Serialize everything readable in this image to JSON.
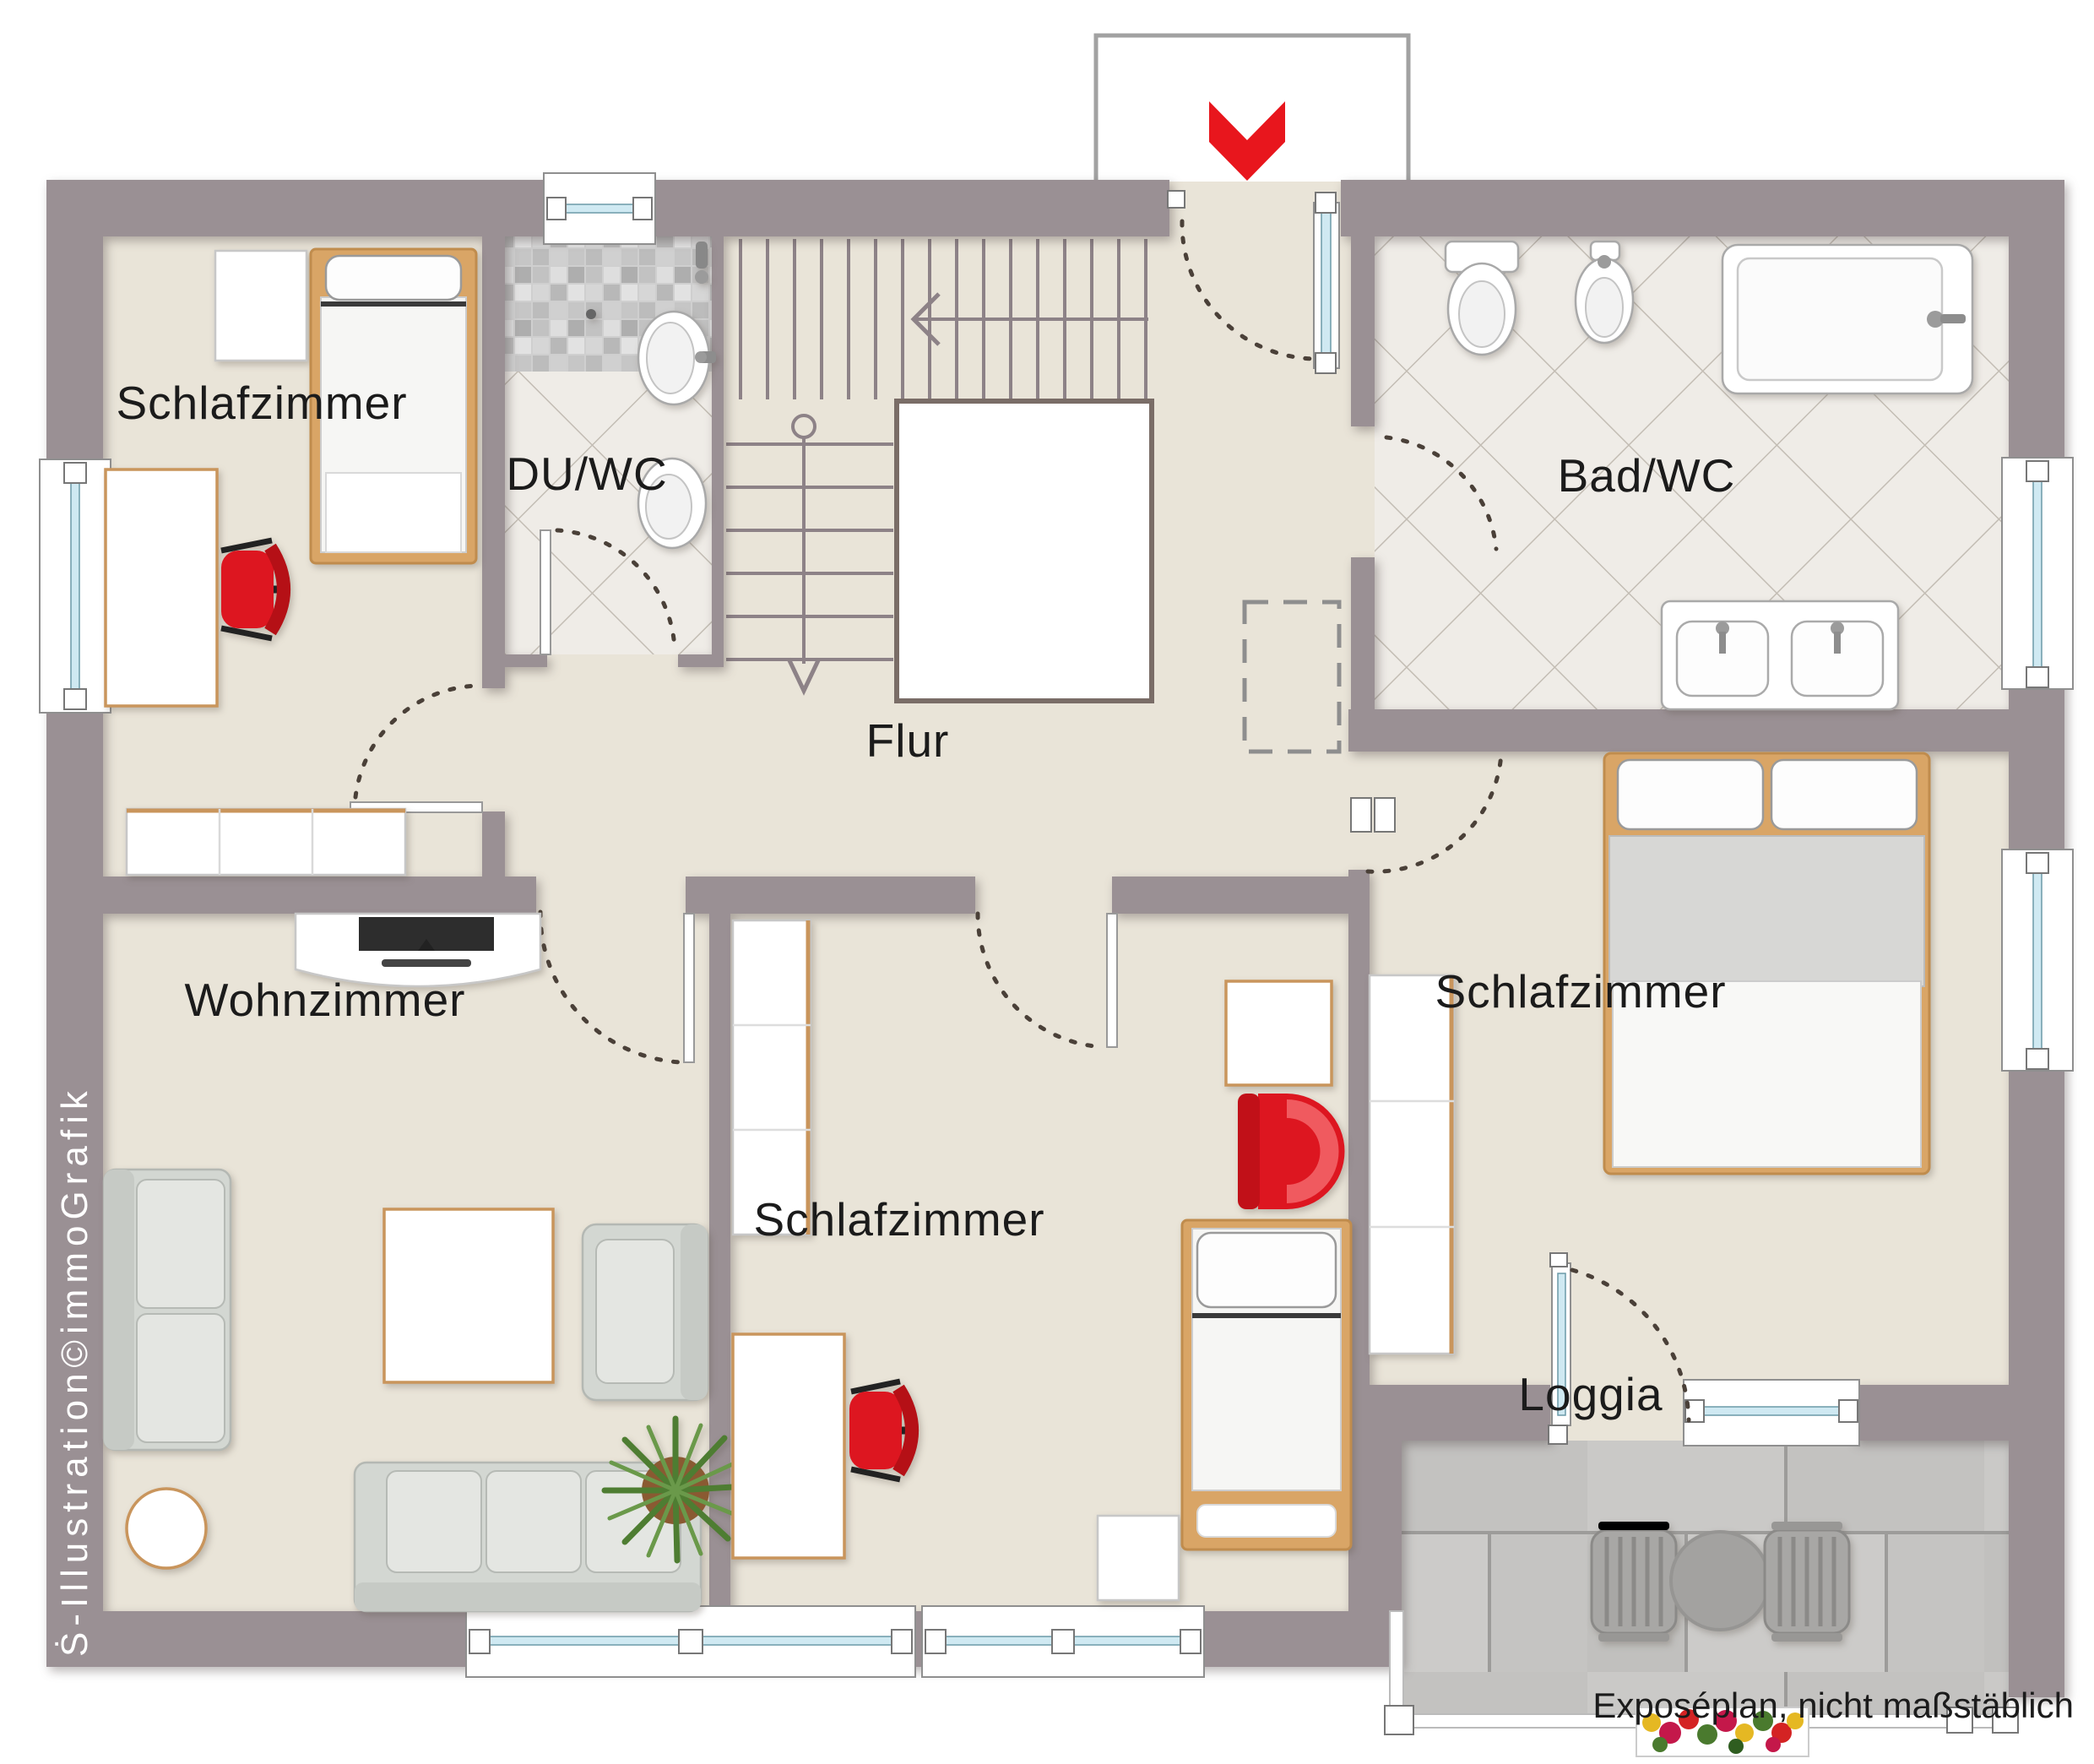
{
  "plan": {
    "rooms": [
      {
        "id": "schlafzimmer-1",
        "label": "Schlafzimmer"
      },
      {
        "id": "du-wc",
        "label": "DU/WC"
      },
      {
        "id": "bad-wc",
        "label": "Bad/WC"
      },
      {
        "id": "flur",
        "label": "Flur"
      },
      {
        "id": "wohnzimmer",
        "label": "Wohnzimmer"
      },
      {
        "id": "schlafzimmer-2",
        "label": "Schlafzimmer"
      },
      {
        "id": "schlafzimmer-3",
        "label": "Schlafzimmer"
      },
      {
        "id": "loggia",
        "label": "Loggia"
      }
    ],
    "footer_note": "Exposéplan, nicht maßstäblich",
    "watermark": "Ṡ-Illustration©immoGrafik",
    "colors": {
      "wall": "#9a9094",
      "floor": "#e9e4d8",
      "accent_red": "#e8161d",
      "bath_tile": "#efece7",
      "mosaic_tile": "#c9c9c9",
      "loggia_tile": "#c7c6c4",
      "wood": "#d9a566",
      "glass": "#cfe9f2",
      "sofa": "#d3d7d2"
    }
  }
}
